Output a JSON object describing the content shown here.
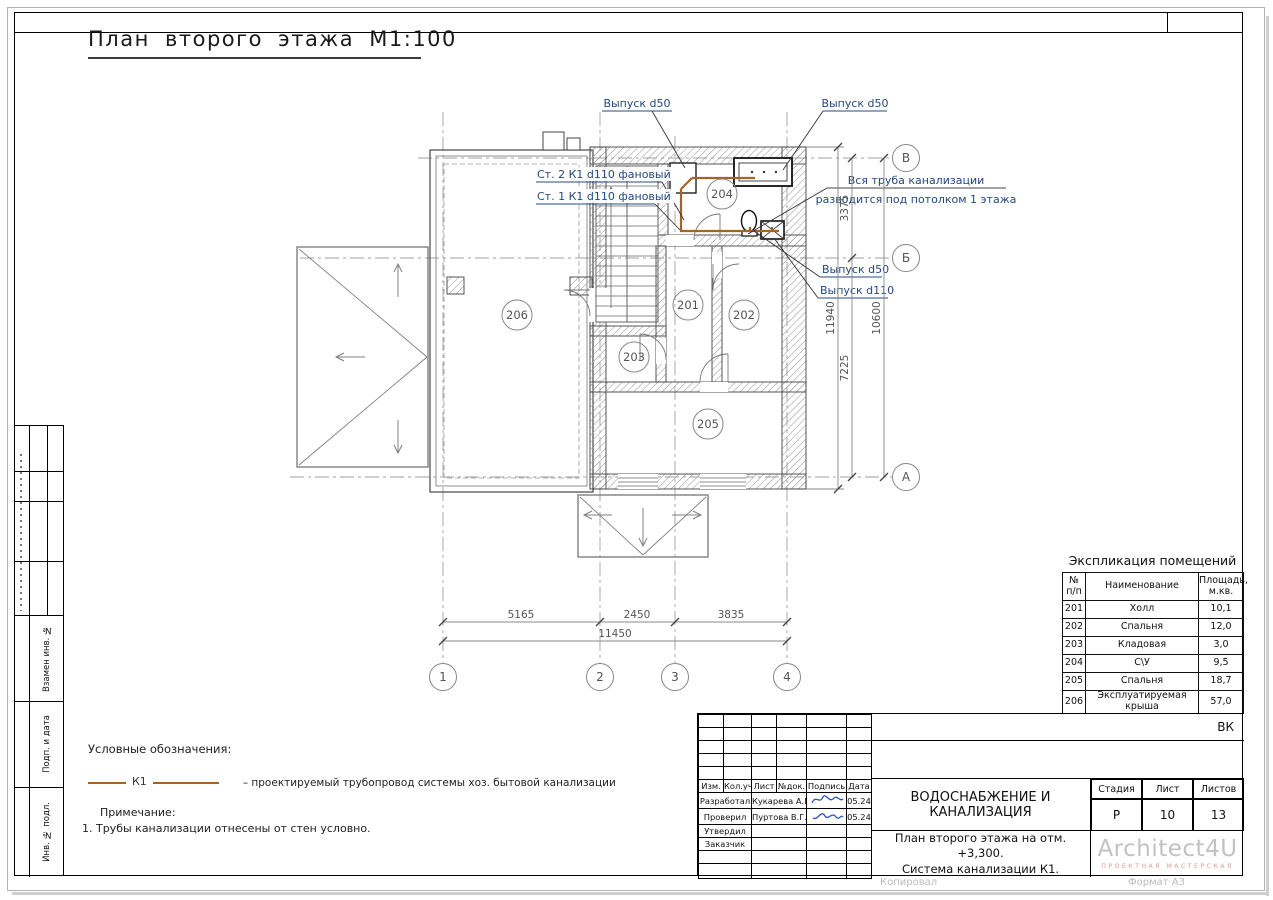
{
  "sheet": {
    "title": "План второго этажа М1:100",
    "stamp_code": "ВК",
    "footer_left": "Копировал",
    "footer_right": "Формат А3"
  },
  "plan": {
    "axes": {
      "v1": "1",
      "v2": "2",
      "v3": "3",
      "v4": "4",
      "hA": "А",
      "hB": "Б",
      "hV": "В"
    },
    "dims": {
      "seg1": "5165",
      "seg2": "2450",
      "seg3": "3835",
      "total_bottom": "11450",
      "right_seg1": "3375",
      "right_seg2": "7225",
      "right_inner": "10600",
      "right_outer": "11940"
    },
    "rooms": {
      "r201": "201",
      "r202": "202",
      "r203": "203",
      "r204": "204",
      "r205": "205",
      "r206": "206"
    },
    "annotations": {
      "outlet50_left": "Выпуск d50",
      "outlet50_right": "Выпуск d50",
      "riser2": "Ст. 2 К1 d110 фановый",
      "riser1": "Ст. 1 К1 d110 фановый",
      "ceiling_note_1": "Вся труба канализации",
      "ceiling_note_2": "разводится под потолком 1 этажа",
      "outlet50_mid": "Выпуск d50",
      "outlet110": "Выпуск d110"
    }
  },
  "legend": {
    "title": "Условные обозначения:",
    "k1_label": "К1",
    "k1_desc": "– проектируемый трубопровод системы хоз. бытовой канализации",
    "note_title": "Примечание:",
    "note_1": "1. Трубы канализации отнесены  от стен условно."
  },
  "room_schedule": {
    "title": "Экспликация помещений",
    "col_num_1": "№",
    "col_num_2": "п/п",
    "col_name": "Наименование",
    "col_area_1": "Площадь,",
    "col_area_2": "м.кв.",
    "rows": [
      {
        "num": "201",
        "name": "Холл",
        "area": "10,1"
      },
      {
        "num": "202",
        "name": "Спальня",
        "area": "12,0"
      },
      {
        "num": "203",
        "name": "Кладовая",
        "area": "3,0"
      },
      {
        "num": "204",
        "name": "С\\У",
        "area": "9,5"
      },
      {
        "num": "205",
        "name": "Спальня",
        "area": "18,7"
      },
      {
        "num": "206",
        "name": "Эксплуатируемая крыша",
        "area": "57,0"
      }
    ]
  },
  "title_block": {
    "cols": {
      "izm": "Изм.",
      "koluch": "Кол.уч.",
      "list": "Лист",
      "ndok": "№док.",
      "podpis": "Подпись",
      "data": "Дата"
    },
    "rows": [
      {
        "role": "Разработал",
        "name": "Кукарева А.М.",
        "date": "05.24"
      },
      {
        "role": "Проверил",
        "name": "Пуртова В.Г.",
        "date": "05.24"
      },
      {
        "role": "Утвердил",
        "name": "",
        "date": ""
      },
      {
        "role": "Заказчик",
        "name": "",
        "date": ""
      }
    ],
    "project_title": "ВОДОСНАБЖЕНИЕ И КАНАЛИЗАЦИЯ",
    "doc_title_1": "План второго этажа на отм. +3,300.",
    "doc_title_2": "Система канализации К1.",
    "stage_label": "Стадия",
    "sheet_label": "Лист",
    "sheets_label": "Листов",
    "stage": "Р",
    "sheet": "10",
    "sheets": "13",
    "logo": "Architect4U",
    "logo_sub": "ПРОЕКТНАЯ МАСТЕРСКАЯ"
  },
  "side_stamp": {
    "vzamen": "Взамен инв. №",
    "podp": "Подп. и дата",
    "inv": "Инв. № подл."
  }
}
